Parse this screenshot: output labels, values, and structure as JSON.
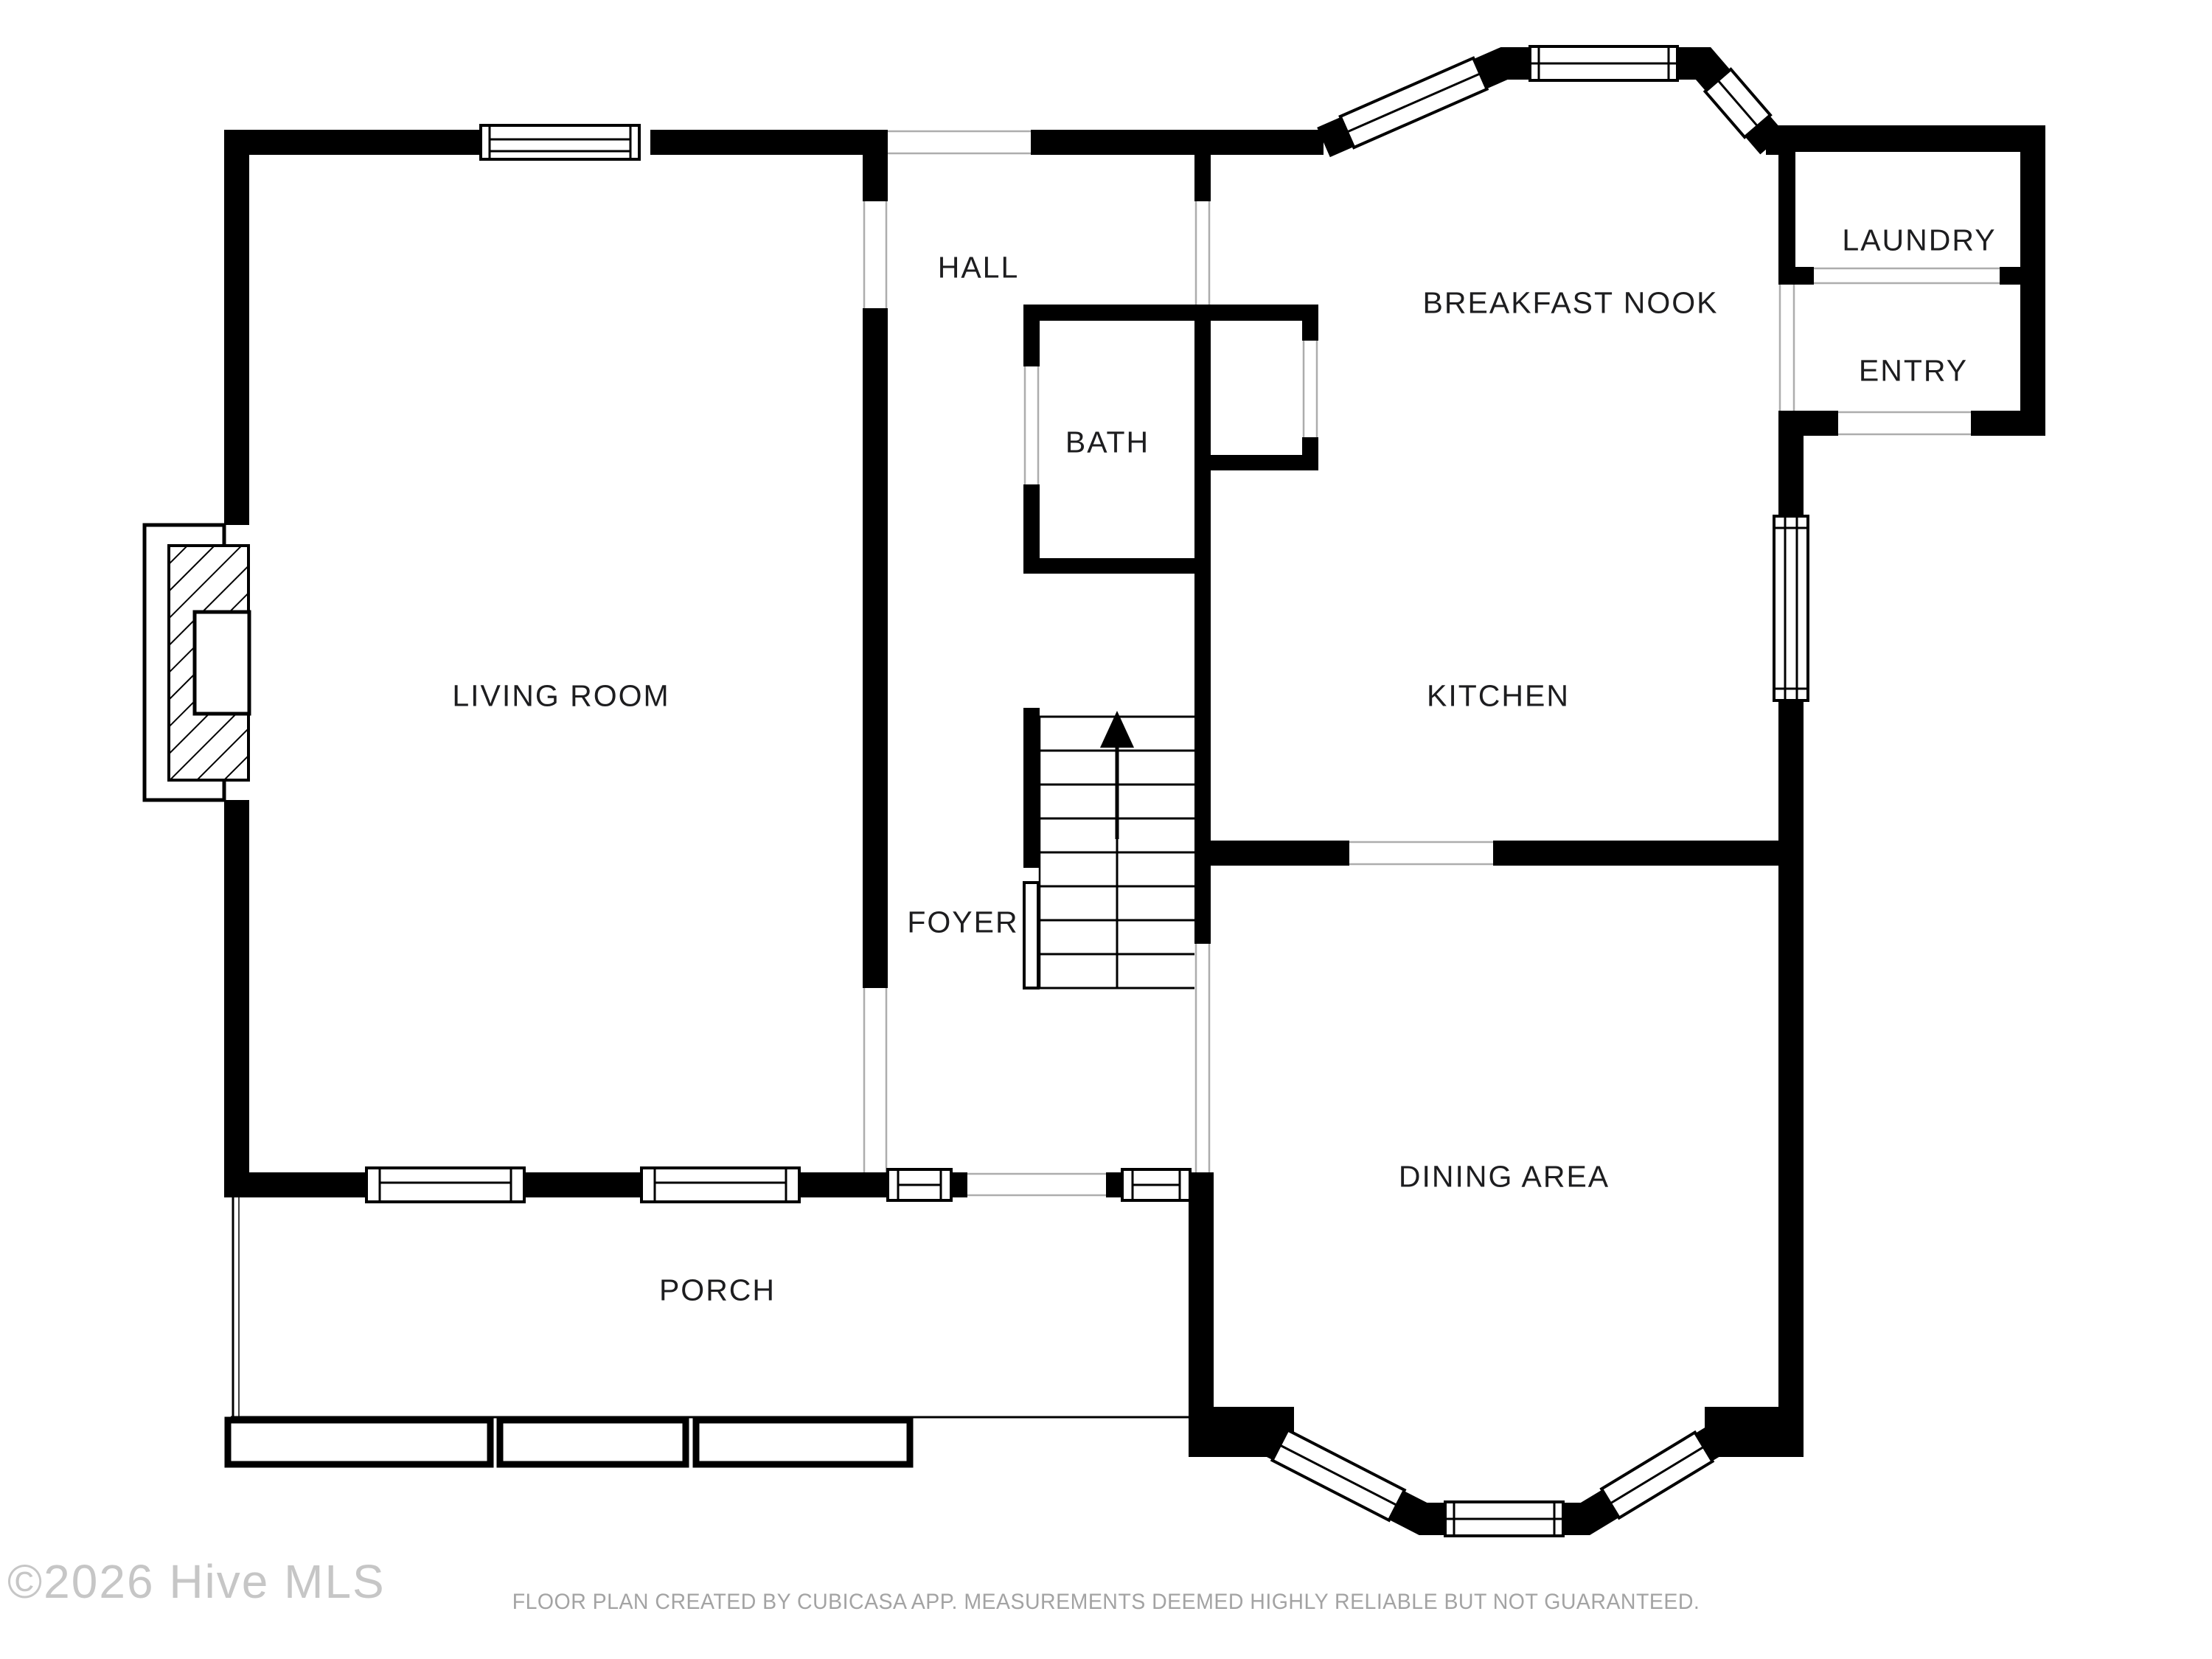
{
  "plan": {
    "rooms": [
      {
        "id": "living-room",
        "label": "LIVING ROOM"
      },
      {
        "id": "hall",
        "label": "HALL"
      },
      {
        "id": "bath",
        "label": "BATH"
      },
      {
        "id": "breakfast-nook",
        "label": "BREAKFAST NOOK"
      },
      {
        "id": "laundry",
        "label": "LAUNDRY"
      },
      {
        "id": "entry",
        "label": "ENTRY"
      },
      {
        "id": "kitchen",
        "label": "KITCHEN"
      },
      {
        "id": "foyer",
        "label": "FOYER"
      },
      {
        "id": "dining-area",
        "label": "DINING AREA"
      },
      {
        "id": "porch",
        "label": "PORCH"
      }
    ],
    "stairs_direction": "up"
  },
  "watermark": {
    "text": "©2026 Hive MLS"
  },
  "footer": {
    "disclaimer": "FLOOR PLAN CREATED BY CUBICASA APP. MEASUREMENTS DEEMED HIGHLY RELIABLE BUT NOT GUARANTEED."
  },
  "colors": {
    "walls": "#000000",
    "background": "#ffffff",
    "labels": "#1d1d1f",
    "opening_lines": "#adadad",
    "watermark": "#c6c6c6",
    "disclaimer": "#a3a3a3"
  }
}
